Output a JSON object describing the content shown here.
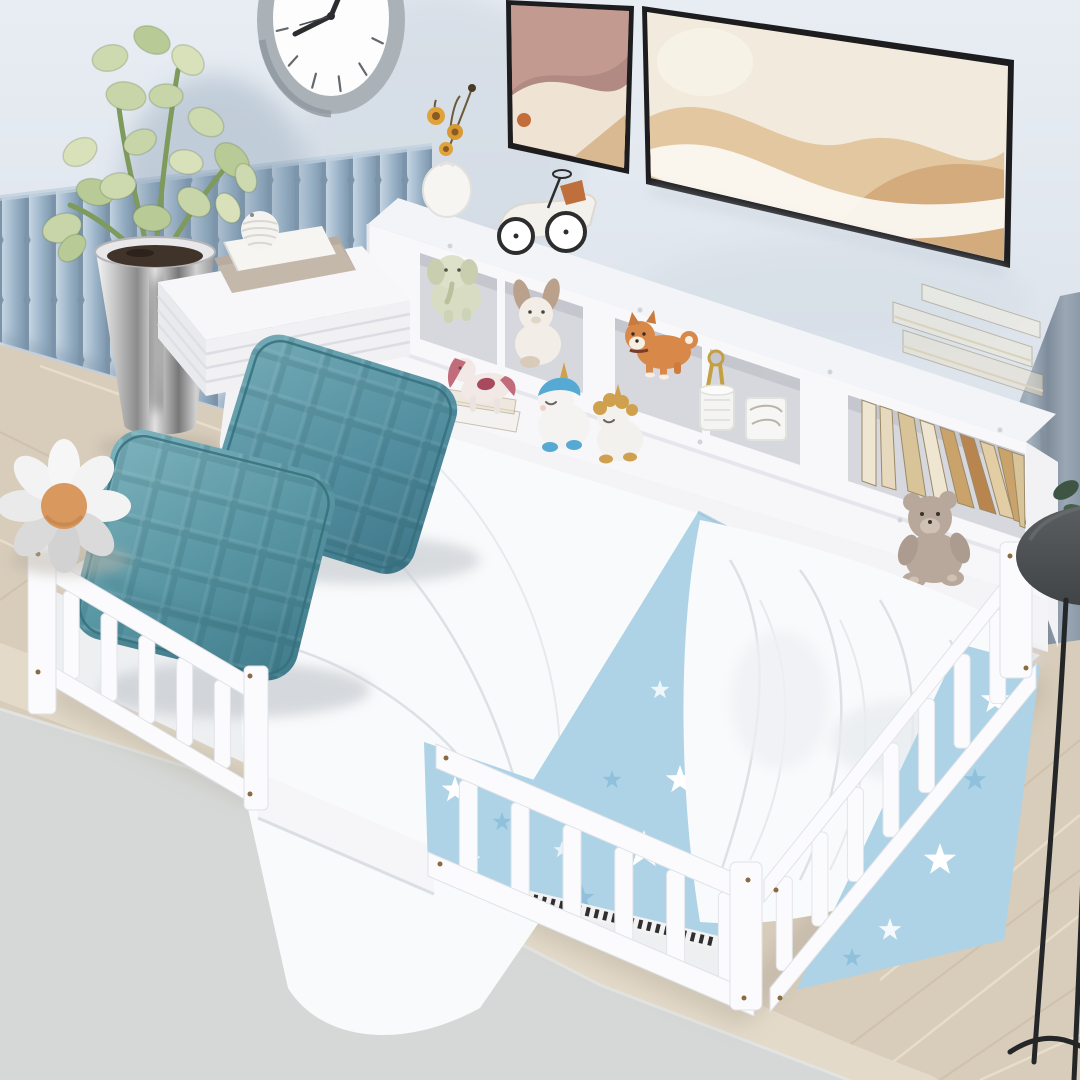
{
  "meta": {
    "description": "Product photograph of a white toddler floor bed with slatted safety rails and an attached white bookcase headboard shelf, styled in a pastel children's bedroom",
    "image_type": "photograph",
    "visible_text": "none"
  },
  "palette": {
    "wall": "#e2e8ef",
    "wall_shade": "#cbd5e0",
    "panel_blue": "#8da6bb",
    "panel_blue_light": "#c6d5e2",
    "panel_blue_dark": "#7b94aa",
    "clock_rim": "#b3babf",
    "clock_face": "#fdfdfe",
    "clock_hands": "#2b2d30",
    "frame_black": "#1d1d1f",
    "art_mauve": "#b28a84",
    "art_cream": "#f2ebdd",
    "art_tan": "#e2c7a1",
    "curtain": "#8d9aa9",
    "shelf_white": "#f8f8fa",
    "shelf_opening": "#d7d8dd",
    "rail_white": "#fbfbfd",
    "sheet": "#f2f3f5",
    "duvet": "#f9fafb",
    "blanket_blue": "#aed3e6",
    "star_white": "#ffffff",
    "star_blue": "#8fc1dc",
    "pillow_teal": "#5a97a4",
    "pillow_teal_dark": "#3f7a8a",
    "pillow_teal_light": "#7fb4be",
    "wood_floor": "#d8ccba",
    "wood_line": "#ece1cf",
    "floor_beige": "#e4dac9",
    "rug_gray": "#d6d8d7",
    "plant_green": "#c7d5a8",
    "plant_stem": "#7e9a5c",
    "soil": "#40342a",
    "daisy_center": "#d8985e",
    "daisy_petal": "#f3f3f3",
    "toy_orange": "#d8894a",
    "toy_gold": "#cfa14f",
    "toy_blue": "#56a9d3",
    "toy_pink": "#c26b7a",
    "teddy_gray": "#b7a89b",
    "book_cream": "#efe6d2",
    "book_tan": "#d9c49a",
    "book_brown": "#b9854e",
    "lamp_dark": "#4d5154",
    "screw_bronze": "#8a6a40",
    "zebra_dark": "#2f2f2f"
  },
  "objects": [
    {
      "name": "wall",
      "label": "light blue-gray wall"
    },
    {
      "name": "slat-panel",
      "label": "blue upholstered slat wainscoting panel"
    },
    {
      "name": "wall-clock",
      "label": "round gray-rim wall clock, partially cropped at top"
    },
    {
      "name": "art-frame-small",
      "label": "small abstract art print, mauve and cream"
    },
    {
      "name": "art-frame-large",
      "label": "large abstract art print, cream and tan waves, black frame"
    },
    {
      "name": "curtain",
      "label": "gray-blue curtain at right edge"
    },
    {
      "name": "bookcase-headboard",
      "label": "white bookcase headboard with cubbies and lower ledge"
    },
    {
      "name": "flower-vase",
      "label": "white teardrop vase with dried yellow flowers"
    },
    {
      "name": "toy-race-car",
      "label": "white vintage toy race car with orange seat"
    },
    {
      "name": "elephant-plush",
      "label": "pale sage elephant plush in cubby"
    },
    {
      "name": "bunny-plush",
      "label": "white bunny plush with brown ears"
    },
    {
      "name": "shiba-figurine",
      "label": "orange shiba dog figurine"
    },
    {
      "name": "hanging-keys",
      "label": "gold toy keys on ring"
    },
    {
      "name": "white-jar",
      "label": "small white jar"
    },
    {
      "name": "white-gift-box",
      "label": "small white box"
    },
    {
      "name": "pony-figurine",
      "label": "pink-maned pony on mini book stack"
    },
    {
      "name": "unicorn-blue",
      "label": "white unicorn figurine with blue mane"
    },
    {
      "name": "unicorn-gold",
      "label": "white unicorn figurine with gold mane"
    },
    {
      "name": "teddy-plush",
      "label": "gray teddy plush on shelf ledge"
    },
    {
      "name": "books-horizontal",
      "label": "stacked cream books on shelf top"
    },
    {
      "name": "books-vertical",
      "label": "row of leaning cream, tan and brown books"
    },
    {
      "name": "side-table",
      "label": "white side table with ridged edge and round leg"
    },
    {
      "name": "table-books",
      "label": "two books on side table"
    },
    {
      "name": "striped-sphere",
      "label": "white grooved decorative sphere"
    },
    {
      "name": "potted-plant",
      "label": "succulent plant in chrome pot"
    },
    {
      "name": "floor-bed",
      "label": "white floor bed frame with slatted guard rails"
    },
    {
      "name": "pillow-front",
      "label": "teal quilted pillow (front)"
    },
    {
      "name": "pillow-back",
      "label": "teal quilted pillow (back)"
    },
    {
      "name": "white-duvet",
      "label": "white flat duvet"
    },
    {
      "name": "star-blanket",
      "label": "light blue star-print blanket with zebra fringe"
    },
    {
      "name": "crumpled-duvet",
      "label": "crumpled white duvet"
    },
    {
      "name": "daisy-plush",
      "label": "daisy flower plush on rug"
    },
    {
      "name": "rug",
      "label": "light gray area rug"
    },
    {
      "name": "wood-floor",
      "label": "light herringbone wood floor"
    },
    {
      "name": "side-stool",
      "label": "dark round stool / lamp at right edge"
    }
  ]
}
